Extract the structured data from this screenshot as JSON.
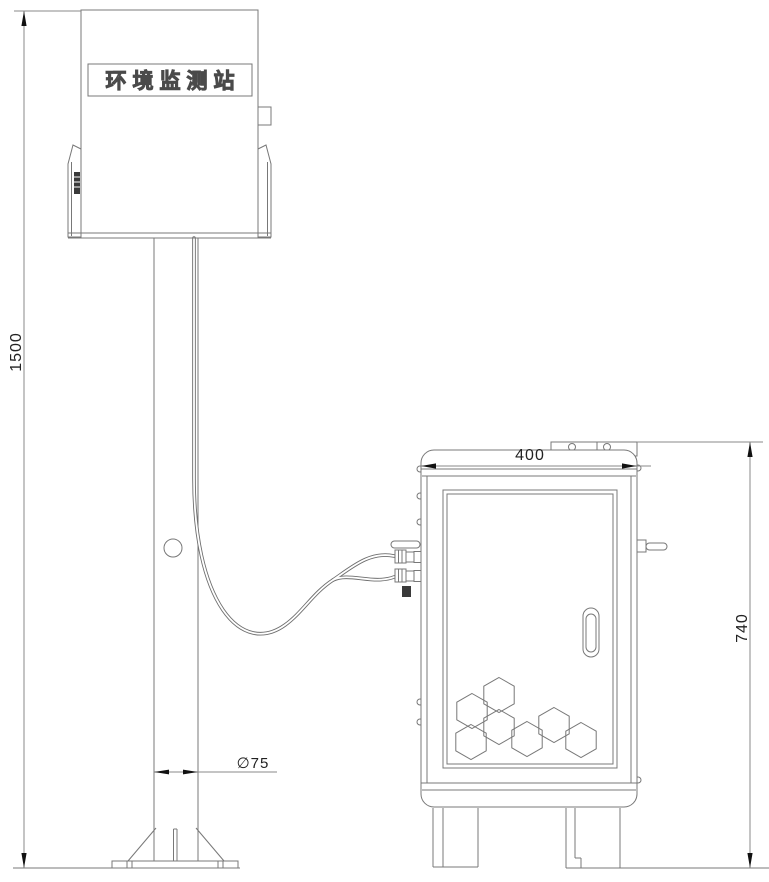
{
  "drawing": {
    "station_label": "环境监测站",
    "dimensions": {
      "pole_height": "1500",
      "cabinet_width": "400",
      "cabinet_height": "740",
      "pole_diameter": "∅75"
    },
    "colors": {
      "line": "#787878",
      "dimension_text": "#222222",
      "arrow": "#111111",
      "background": "#ffffff",
      "dark_detail": "#3a3a3a"
    }
  }
}
